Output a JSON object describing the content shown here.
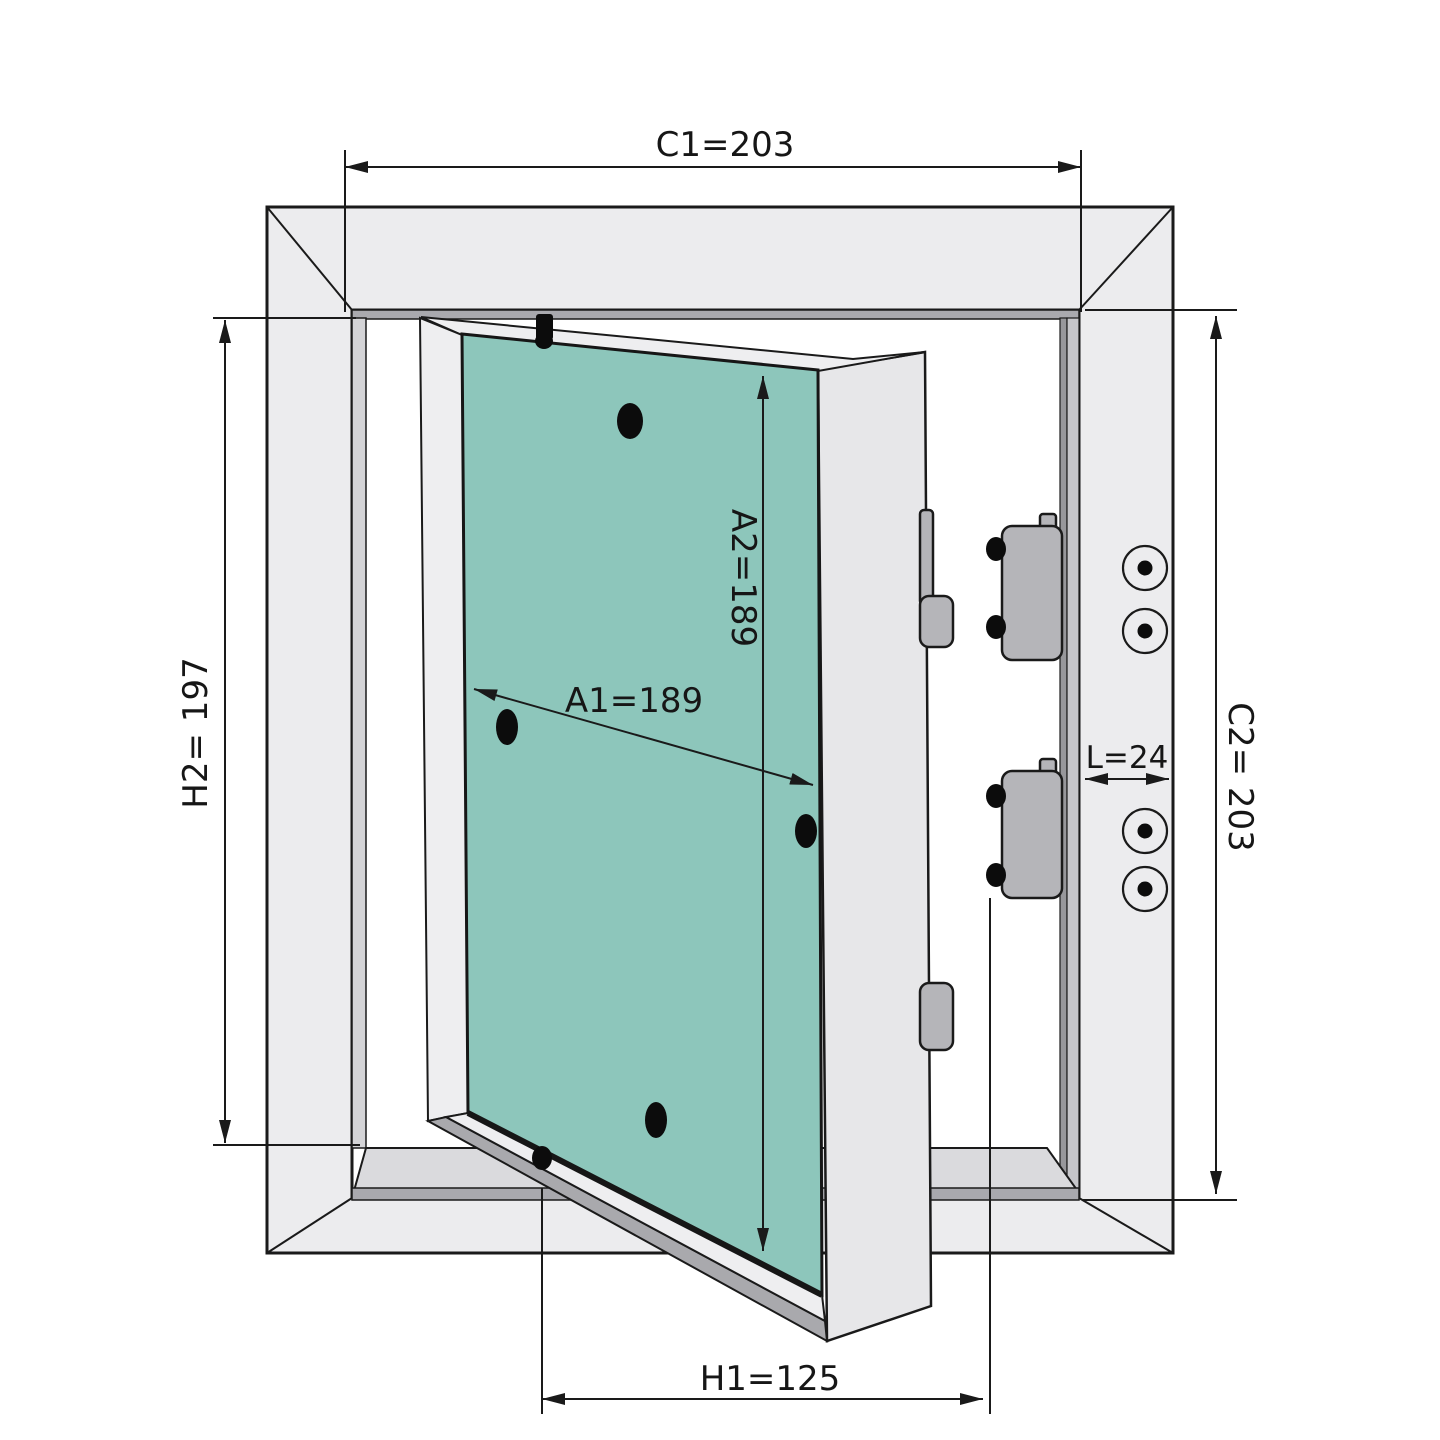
{
  "diagram": {
    "type": "technical-drawing",
    "subject": "access-panel-frame-with-open-inspection-door",
    "background_color": "#ffffff",
    "line_color": "#1a1a1a",
    "colors": {
      "frame_face": "#ececee",
      "frame_recess_light": "#d4d4d7",
      "frame_recess_dark": "#a9a9ae",
      "frame_right_recess": "#c6c6ca",
      "door_face": "#eeeef0",
      "door_side_face": "#e7e7e9",
      "door_panel_teal": "#8dc6bb",
      "hinge_rail": "#bcbcc0",
      "door_edge_dark": "#a9a9ad",
      "hardware_gray": "#b5b5b9"
    },
    "dimensions": {
      "c1": {
        "label": "C1=203",
        "value": 203,
        "orientation": "horizontal"
      },
      "c2": {
        "label": "C2= 203",
        "value": 203,
        "orientation": "vertical"
      },
      "h2": {
        "label": "H2= 197",
        "value": 197,
        "orientation": "vertical"
      },
      "h1": {
        "label": "H1=125",
        "value": 125,
        "orientation": "horizontal"
      },
      "a1": {
        "label": "A1=189",
        "value": 189,
        "orientation": "diagonal"
      },
      "a2": {
        "label": "A2=189",
        "value": 189,
        "orientation": "vertical"
      },
      "l": {
        "label": "L=24",
        "value": 24,
        "orientation": "horizontal"
      }
    },
    "features": {
      "frame_screw_holes": 4,
      "panel_screw_marks": 4,
      "hinge_pins": 2,
      "latch_blocks": 2,
      "latch_hooks": 2
    }
  }
}
